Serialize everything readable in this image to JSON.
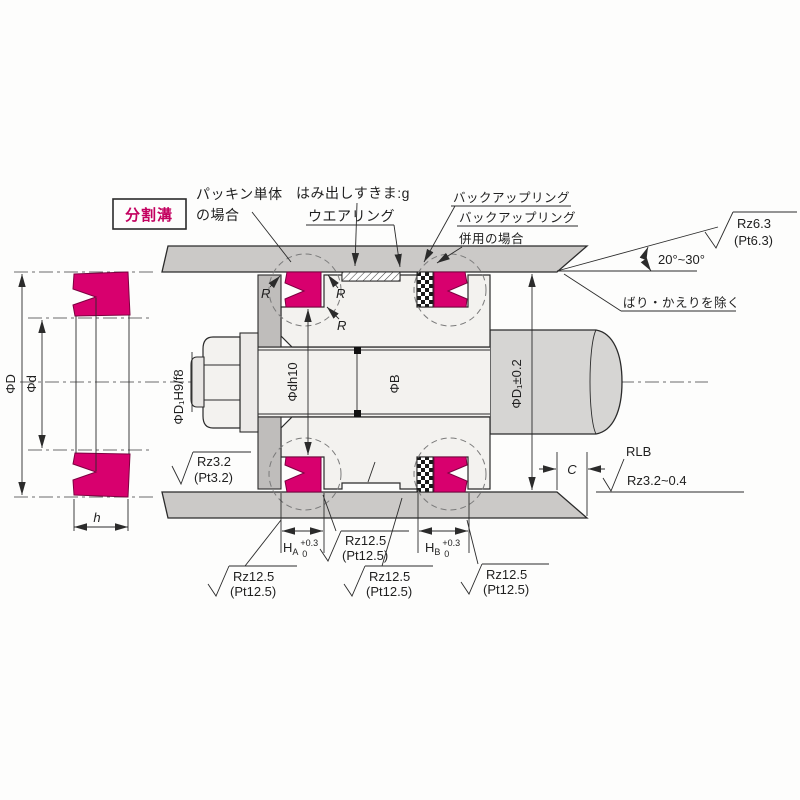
{
  "drawing": {
    "split_groove_box": "分割溝",
    "callouts": {
      "packing_only_line1": "パッキン単体",
      "packing_only_line2": "の場合",
      "extrusion_gap": "はみ出しすきま:g",
      "wear_ring": "ウエアリング",
      "backup_ring": "バックアップリング",
      "backup_ring_combined_line1": "バックアップリング",
      "backup_ring_combined_line2": "併用の場合",
      "deburr_note": "ばり・かえりを除く",
      "chamfer_angle": "20°~30°",
      "rlb_label": "RLB"
    },
    "dimensions": {
      "seal_od": "ΦD",
      "seal_id": "Φd",
      "seal_width": "h",
      "fit_spec": "ΦD₁H9/f8",
      "groove_root_dia": "Φdh10",
      "shank_dia": "ΦB",
      "bore_dia": "ΦD₁±0.2",
      "chamfer_length": "C",
      "corner_radius": "R",
      "groove_width_a_base": "H",
      "groove_width_a_sub": "A",
      "groove_width_b_base": "H",
      "groove_width_b_sub": "B",
      "tolerance_upper": "+0.3",
      "tolerance_lower": "0"
    },
    "surface_roughness": {
      "rz63": "Rz6.3",
      "pt63": "(Pt6.3)",
      "rz32": "Rz3.2",
      "pt32": "(Pt3.2)",
      "rz125": "Rz12.5",
      "pt125": "(Pt12.5)",
      "rlb_range": "Rz3.2~0.4"
    },
    "colors": {
      "seal": "#d8006e",
      "seal_outline": "#7c0040",
      "metal_light": "#cbc9c7",
      "metal_mid": "#bfbdbb",
      "accent_text": "#c3005f",
      "line": "#2b2b2b"
    }
  }
}
